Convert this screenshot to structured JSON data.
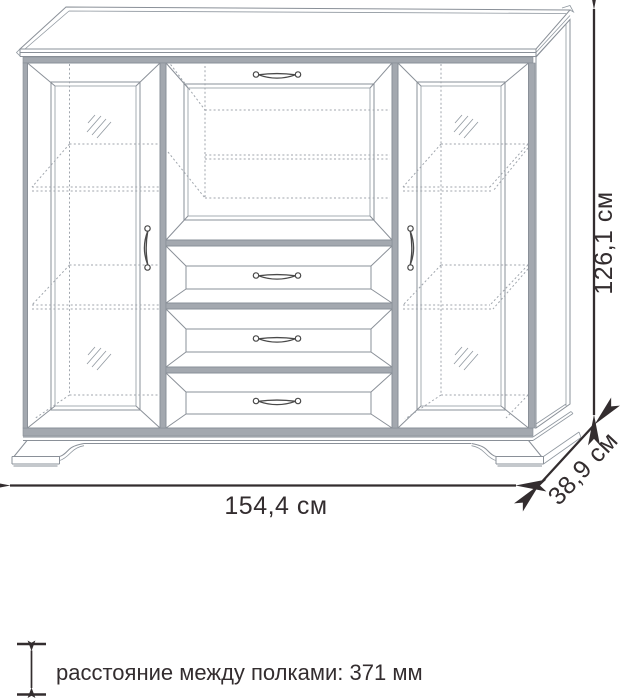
{
  "diagram": {
    "kind": "furniture-dimension-drawing",
    "item": "sideboard with two glass doors, fold-down flap and three drawers",
    "labels": {
      "width": "154,4 см",
      "height": "126,1 см",
      "depth": "38,9 см",
      "legend": "расстояние между полками: 371 мм"
    },
    "counts": {
      "drawers": 3,
      "doors": 2,
      "handles": 6
    },
    "icons": {
      "width_arrow": "horizontal-double-arrow",
      "height_arrow": "vertical-double-arrow",
      "depth_arrow": "diagonal-double-arrow",
      "legend_arrow": "small-vertical-double-arrow",
      "glass_mark": "diagonal-hatch",
      "pull": "bow-handle"
    },
    "colors": {
      "background": "#ffffff",
      "line": "#8a9098",
      "hidden_line": "#a0a6ad",
      "frame_fill": "#a3a8af",
      "handle": "#4a4a4a",
      "dimension": "#332d2f"
    }
  }
}
